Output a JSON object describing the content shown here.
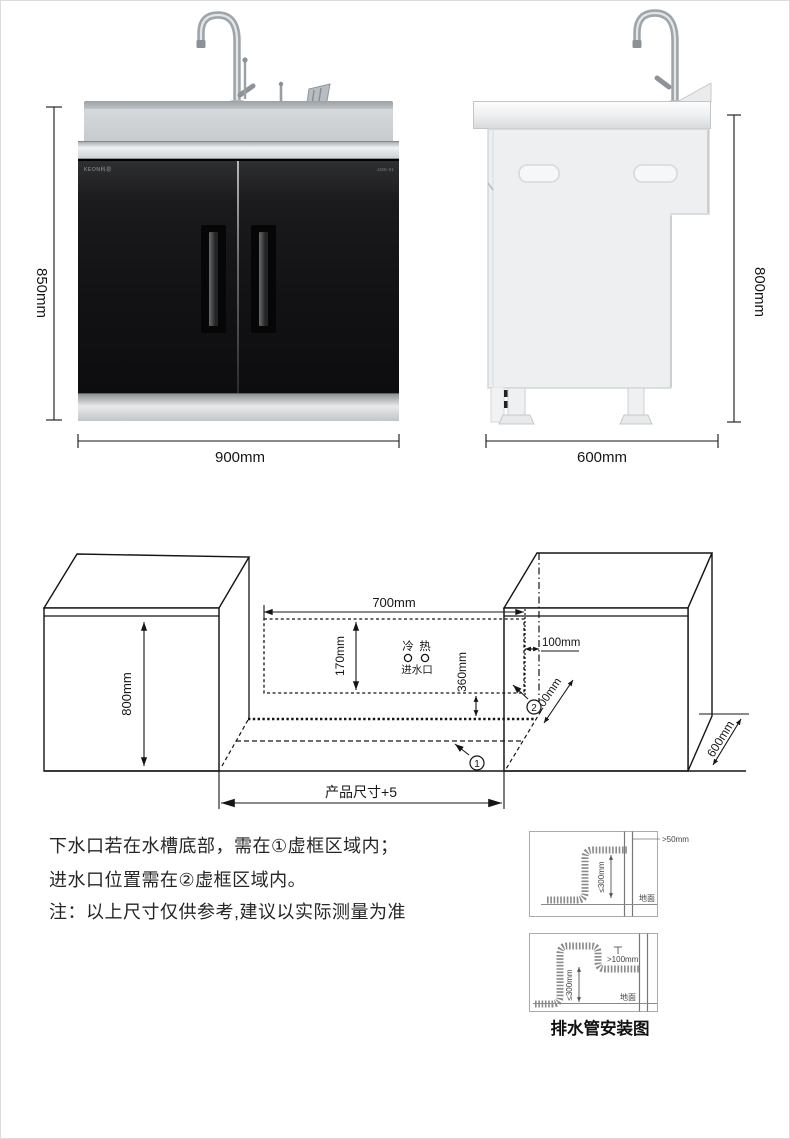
{
  "front_view": {
    "brand": "KEON科恩",
    "model": "JJSK-X1",
    "height": "850mm",
    "width": "900mm"
  },
  "side_view": {
    "height": "800mm",
    "depth": "600mm"
  },
  "install": {
    "cabinet_height": "800mm",
    "zone2_width": "700mm",
    "zone2_height": "170mm",
    "side_gap": "100mm",
    "bottom_offset": "360mm",
    "depth_gap": "100mm",
    "cabinet_depth": "600mm",
    "opening_width": "产品尺寸+5",
    "cold": "冷",
    "hot": "热",
    "inlet": "进水口",
    "zone1": "1",
    "zone2": "2"
  },
  "notes": {
    "line1": "下水口若在水槽底部，需在①虚框区域内；",
    "line2": "进水口位置需在②虚框区域内。",
    "line3": "注：以上尺寸仅供参考,建议以实际测量为准"
  },
  "drain": {
    "caption": "排水管安装图",
    "top_gap": ">50mm",
    "top_height": "≤300mm",
    "top_ground": "地面",
    "bottom_gap": ">100mm",
    "bottom_height": "≤300mm",
    "bottom_ground": "地面"
  }
}
